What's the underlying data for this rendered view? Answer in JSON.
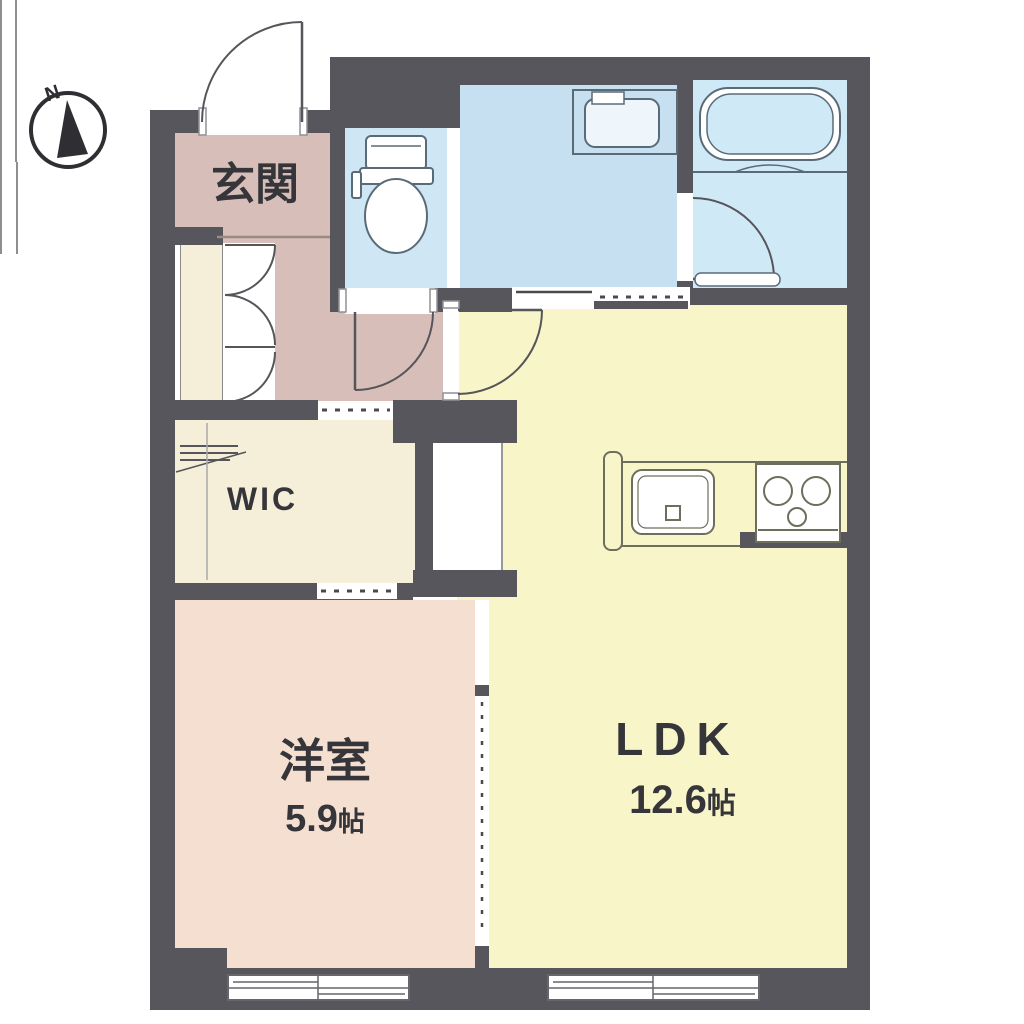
{
  "floor_plan": {
    "compass": {
      "label": "N"
    },
    "rooms": {
      "genkan": {
        "label": "玄関"
      },
      "wic": {
        "label": "WIC"
      },
      "western_room": {
        "label": "洋室",
        "size_value": "5.9",
        "size_unit": "帖"
      },
      "ldk": {
        "label": "LDK",
        "size_value": "12.6",
        "size_unit": "帖"
      }
    },
    "colors": {
      "wall": "#57565c",
      "hall": "#d7beb9",
      "western": "#f4dfd1",
      "ldk": "#f8f5c9",
      "wic": "#f5efd9",
      "toilet": "#cfe7f5",
      "washroom": "#c6e0f1",
      "bath": "#d0e9f6",
      "fixture": "#5a6b78",
      "kitchen": "#6e6e5c",
      "door": "#55555a"
    }
  }
}
